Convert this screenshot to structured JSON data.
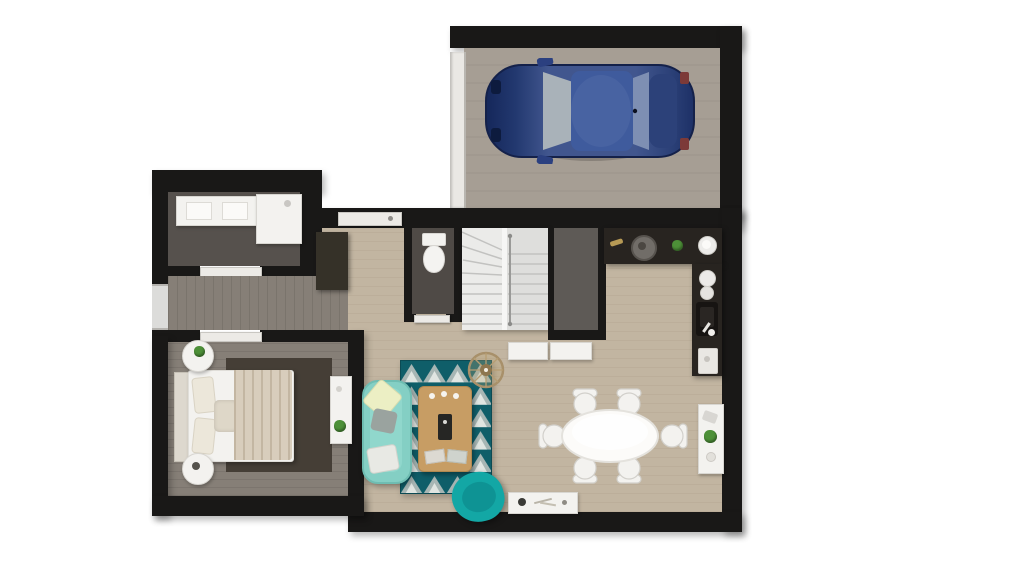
{
  "scene": {
    "kind": "3d-floor-plan-top-down-render",
    "background": "#ffffff",
    "floors_shown": 1
  },
  "colors": {
    "wall": "#191817",
    "garage_floor": "#a69e94",
    "garage_door": "#eae8e4",
    "car_body": "#41568e",
    "car_hood": "#15275a",
    "car_roof": "#3f5b9d",
    "car_glass": "#a9b2b9",
    "floor_light_wood": "#c2b5a1",
    "floor_gray_wood": "#867f77",
    "bath_floor": "#56514d",
    "wc_floor": "#4f4a46",
    "pantry_floor": "#5e5a56",
    "stair_light": "#ebebe9",
    "stair_dark": "#dededc",
    "counter": "#282420",
    "sink_basin": "#171412",
    "white_furn": "#f3f2ef",
    "sofa": "#84cfc4",
    "armchair": "#13a7a5",
    "rug_teal": "#0f5e69",
    "rug_gray": "#a7b6b4",
    "rug_white": "#e0e5e1",
    "coffee_table": "#c79d64",
    "bed_rug": "#453e36",
    "blanket": "#d8cdbc",
    "plant": "#4d9038",
    "rattan": "#a8906a",
    "window": "#dcdcda"
  },
  "rooms": {
    "garage": {
      "label": "Garage"
    },
    "bathroom": {
      "label": "Bathroom"
    },
    "hallway": {
      "label": "Hallway"
    },
    "bedroom": {
      "label": "Bedroom"
    },
    "entry": {
      "label": "Entry"
    },
    "wc": {
      "label": "WC"
    },
    "staircase": {
      "label": "Staircase"
    },
    "pantry": {
      "label": "Storage room"
    },
    "kitchen": {
      "label": "Kitchen"
    },
    "living": {
      "label": "Living room"
    },
    "dining": {
      "label": "Dining area"
    }
  },
  "furniture": {
    "car": {
      "label": "Blue car parked in garage"
    },
    "vanity": {
      "label": "Double-sink vanity"
    },
    "shower": {
      "label": "Walk-in shower"
    },
    "toilet": {
      "label": "Toilet"
    },
    "bed": {
      "label": "Double bed with beige throw"
    },
    "nightstand_top": {
      "label": "Round nightstand with plant"
    },
    "nightstand_bottom": {
      "label": "Round nightstand"
    },
    "bedroom_console": {
      "label": "Bedroom console shelf"
    },
    "wardrobe": {
      "label": "Entry wardrobe"
    },
    "sofa": {
      "label": "Teal sofa with cushions"
    },
    "armchair": {
      "label": "Teal swivel armchair"
    },
    "rug": {
      "label": "Triangle-pattern rug"
    },
    "coffee_table": {
      "label": "Wooden coffee table"
    },
    "pendant": {
      "label": "Rattan pendant lamp"
    },
    "dining_table": {
      "label": "Oval dining table with six chairs"
    },
    "dining_console": {
      "label": "Dining console with plant"
    },
    "bench": {
      "label": "Low white bench with decor"
    },
    "kitchen_counter": {
      "label": "L-shaped dark kitchen counter"
    },
    "kitchen_sink": {
      "label": "Kitchen sink with faucet"
    },
    "hall_cabinets": {
      "label": "White hall cabinets"
    },
    "stairs": {
      "label": "Winder staircase"
    }
  }
}
